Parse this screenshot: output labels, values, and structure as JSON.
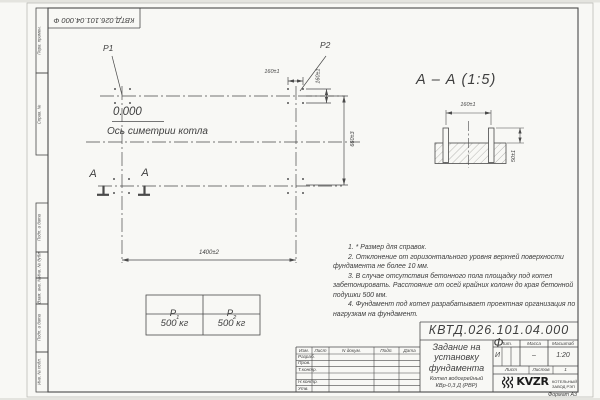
{
  "stamp_vertical": {
    "code": "КВТД.026.101.04.000  Ф"
  },
  "margin_fields": [
    {
      "label": "Перв. примен."
    },
    {
      "label": "Справ. №"
    },
    {
      "label": "Подп. и дата"
    },
    {
      "label": "Инв. № дубл."
    },
    {
      "label": "Взам. инв. №"
    },
    {
      "label": "Подп. и дата"
    },
    {
      "label": "Инв. № подл."
    }
  ],
  "plan": {
    "load_label_1": "P1",
    "load_label_2": "P2",
    "elevation": "0.000",
    "axis_label": "Ось симетрии котла",
    "dim_bolt_spacing_h": "160±1",
    "dim_bolt_spacing_v": "160±1",
    "dim_width": "660±3",
    "dim_length": "1400±2",
    "section_letter_1": "А",
    "section_letter_2": "А"
  },
  "section": {
    "title": "А – А (1:5)",
    "dim_bolt_spacing": "160±1",
    "dim_bolt_height": "50±1"
  },
  "loads_table": {
    "headers": [
      {
        "base": "P",
        "sub": "1"
      },
      {
        "base": "P",
        "sub": "2"
      }
    ],
    "values": [
      "500 кг",
      "500 кг"
    ]
  },
  "notes": [
    "1. * Размер для справок.",
    "2. Отклонение от горизонтального уровня верхней поверхности фундамента не более 10 мм.",
    "3. В случае отсутствия бетонного пола площадку под котел забетонировать. Расстояние от осей крайних колонн до края бетонной подушки 500 мм.",
    "4. Фундамент под котел разрабатывает проектная организация по нагрузкам на фундамент."
  ],
  "title_block": {
    "designation": "КВТД.026.101.04.000  Ф",
    "doc_title": "Задание на\nустановку\nфундамента",
    "product": "Котел водогрейный\nКВр-0,3 Д (РВР)",
    "lit_label": "Лит.",
    "lit_value": "И",
    "mass_label": "Масса",
    "mass_value": "–",
    "scale_label": "Масштаб",
    "scale_value": "1:20",
    "sheet_label": "Лист",
    "sheets_label": "Листов",
    "sheets_value": "1",
    "header_cols": [
      "Изм.",
      "Лист",
      "N докум.",
      "Подп.",
      "Дата"
    ],
    "sig_rows": [
      "Разраб.",
      "Пров.",
      "Т.контр.",
      "Н.контр.",
      "Утв."
    ],
    "format_note": "Формат А3"
  },
  "logo": {
    "name": "KVZR",
    "caption": "КОТЕЛЬНЫЙ\nЗАВОД РЭП"
  },
  "colors": {
    "line": "#4a4a4a",
    "paper": "#f8f8f5"
  }
}
